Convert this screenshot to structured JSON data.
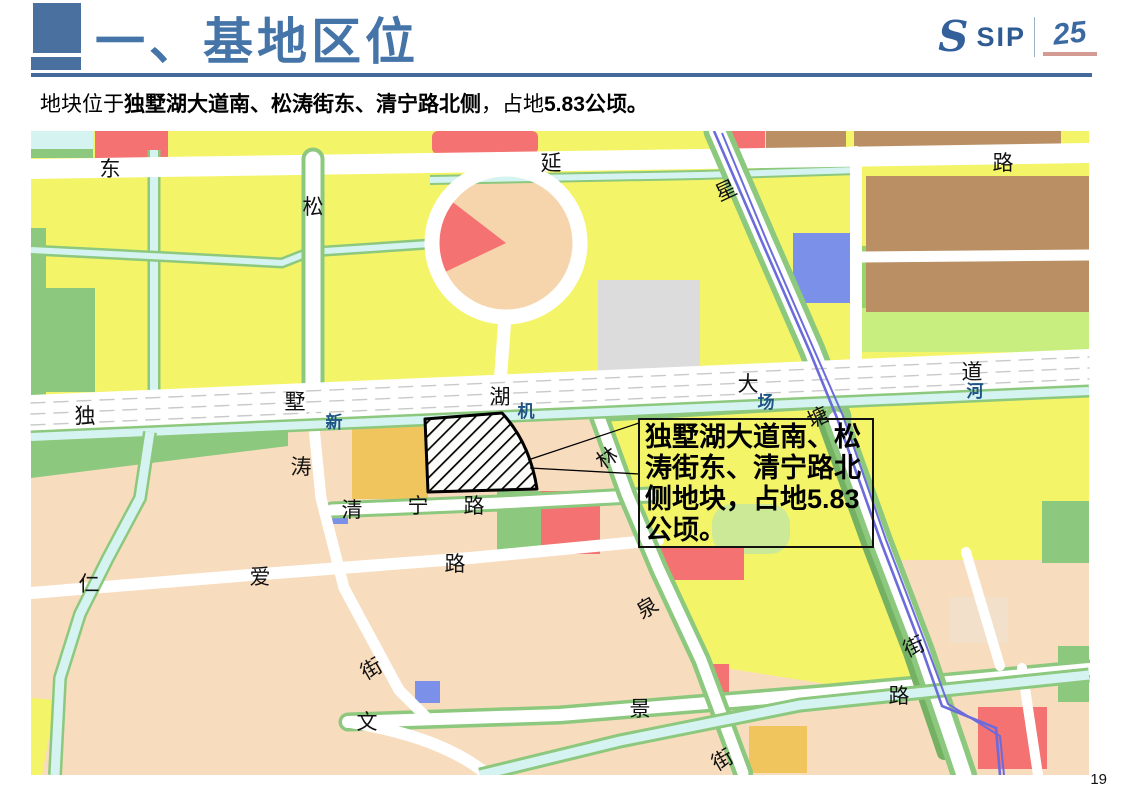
{
  "slide": {
    "title": "一、基地区位",
    "subtitle": {
      "prefix": "地块位于",
      "bold_roads": "独墅湖大道南、松涛街东、清宁路北侧",
      "mid": "，占地",
      "bold_area": "5.83公顷。"
    },
    "page_number": "19"
  },
  "logo": {
    "s": "S",
    "name": "SIP",
    "anniversary": "25"
  },
  "map": {
    "callout": {
      "text": "独墅湖大道南、松涛街东、清宁路北侧地块，占地5.83公顷。"
    },
    "site": {
      "description": "hatched site polygon",
      "area_label": "5.83公顷"
    },
    "colors": {
      "title_accent": "#4574A8",
      "water_label": "#1E5484",
      "residential_yellow": "#F4F468",
      "parcel_peach": "#F8DCBE",
      "parcel_red": "#F47272",
      "parcel_brown": "#B98F63",
      "parcel_green": "#8CC87D",
      "parcel_blue": "#7B90E8",
      "parcel_orange": "#F1C55E",
      "canal_blue": "#D5F3F1",
      "metro_purple": "#6B6BDC"
    },
    "labels": [
      {
        "text": "东",
        "x": 110,
        "y": 176,
        "rot": 0,
        "cls": "rd"
      },
      {
        "text": "延",
        "x": 551,
        "y": 170,
        "rot": 0,
        "cls": "rd"
      },
      {
        "text": "路",
        "x": 1003,
        "y": 170,
        "rot": 0,
        "cls": "rd"
      },
      {
        "text": "松",
        "x": 313,
        "y": 214,
        "rot": 0,
        "cls": "rd"
      },
      {
        "text": "星",
        "x": 729,
        "y": 197,
        "rot": -25,
        "cls": "rd"
      },
      {
        "text": "独",
        "x": 85,
        "y": 423,
        "rot": 0,
        "cls": "rd"
      },
      {
        "text": "墅",
        "x": 295,
        "y": 409,
        "rot": 0,
        "cls": "rd"
      },
      {
        "text": "湖",
        "x": 500,
        "y": 404,
        "rot": 0,
        "cls": "rd"
      },
      {
        "text": "大",
        "x": 748,
        "y": 391,
        "rot": 0,
        "cls": "rd"
      },
      {
        "text": "道",
        "x": 972,
        "y": 379,
        "rot": 0,
        "cls": "rd"
      },
      {
        "text": "新",
        "x": 334,
        "y": 428,
        "rot": 0,
        "cls": "wt"
      },
      {
        "text": "机",
        "x": 526,
        "y": 417,
        "rot": 0,
        "cls": "wt"
      },
      {
        "text": "场",
        "x": 766,
        "y": 408,
        "rot": 0,
        "cls": "wt"
      },
      {
        "text": "河",
        "x": 975,
        "y": 397,
        "rot": 0,
        "cls": "wt"
      },
      {
        "text": "塘",
        "x": 821,
        "y": 424,
        "rot": -25,
        "cls": "rd"
      },
      {
        "text": "涛",
        "x": 301,
        "y": 474,
        "rot": 0,
        "cls": "rd"
      },
      {
        "text": "林",
        "x": 611,
        "y": 464,
        "rot": -35,
        "cls": "rd"
      },
      {
        "text": "清",
        "x": 352,
        "y": 517,
        "rot": 0,
        "cls": "rd"
      },
      {
        "text": "宁",
        "x": 418,
        "y": 513,
        "rot": 0,
        "cls": "rd"
      },
      {
        "text": "路",
        "x": 474,
        "y": 513,
        "rot": 0,
        "cls": "rd"
      },
      {
        "text": "仁",
        "x": 89,
        "y": 591,
        "rot": 0,
        "cls": "rd"
      },
      {
        "text": "爱",
        "x": 260,
        "y": 584,
        "rot": 0,
        "cls": "rd"
      },
      {
        "text": "路",
        "x": 455,
        "y": 571,
        "rot": 0,
        "cls": "rd"
      },
      {
        "text": "泉",
        "x": 651,
        "y": 614,
        "rot": -30,
        "cls": "rd"
      },
      {
        "text": "街",
        "x": 375,
        "y": 675,
        "rot": -30,
        "cls": "rd"
      },
      {
        "text": "文",
        "x": 367,
        "y": 729,
        "rot": 0,
        "cls": "rd"
      },
      {
        "text": "景",
        "x": 640,
        "y": 716,
        "rot": 0,
        "cls": "rd"
      },
      {
        "text": "路",
        "x": 899,
        "y": 703,
        "rot": 0,
        "cls": "rd"
      },
      {
        "text": "街",
        "x": 726,
        "y": 766,
        "rot": -30,
        "cls": "rd"
      },
      {
        "text": "街",
        "x": 917,
        "y": 653,
        "rot": -25,
        "cls": "rd"
      }
    ]
  }
}
